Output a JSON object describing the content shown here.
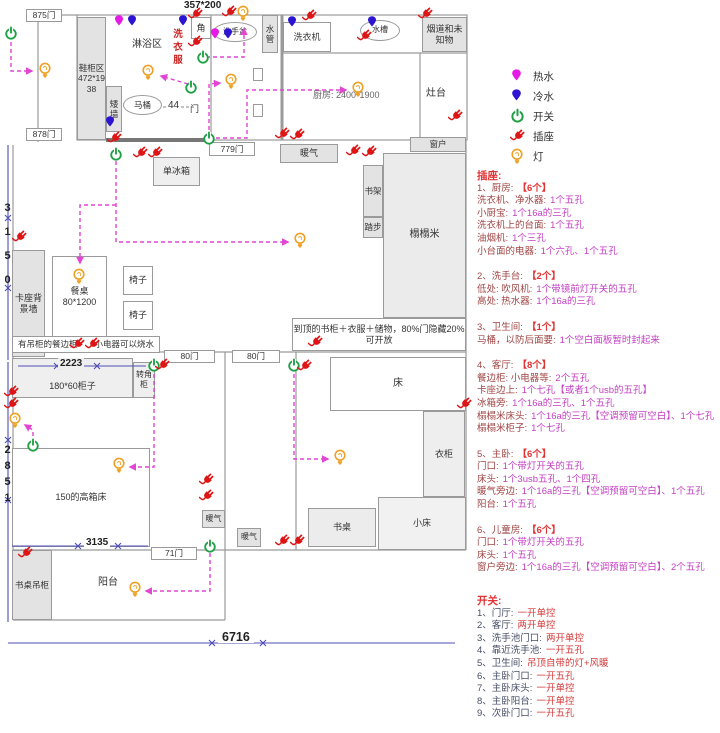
{
  "colors": {
    "hot_water": "#e61ae6",
    "cold_water": "#2d14d2",
    "switch": "#1fa045",
    "outlet": "#dd1515",
    "light": "#f0a125",
    "route_dashed": "#e245d2",
    "dimension": "#4f4fb5",
    "wall": "#9a9a9a",
    "panel_header": "#e23333",
    "panel_label": "#a04545",
    "panel_value": "#c43fc4"
  },
  "icons": {
    "hot-water-pin": "teardrop-pin",
    "cold-water-pin": "teardrop-pin",
    "switch-icon": "power-circle",
    "outlet-icon": "plug",
    "light-icon": "bulb"
  },
  "legend": {
    "items": [
      {
        "icon": "hot-water-pin",
        "label": "热水"
      },
      {
        "icon": "cold-water-pin",
        "label": "冷水"
      },
      {
        "icon": "switch-icon",
        "label": "开关"
      },
      {
        "icon": "outlet-icon",
        "label": "插座"
      },
      {
        "icon": "light-icon",
        "label": "灯"
      }
    ]
  },
  "plan": {
    "dim_top": "357*200",
    "door_875": "875门",
    "door_878": "878门",
    "door_779": "779门",
    "door_80": "80门",
    "door_71": "71门",
    "door_char": "门",
    "shoe": "鞋柜区\n472*19\n38",
    "shower": "淋浴区",
    "laundry": "洗\n衣\n服",
    "corner": "角",
    "basin": "洗手盆",
    "pipe": "水\n管",
    "washer": "洗衣机",
    "sink": "水槽",
    "flue": "烟道和未\n知物",
    "stove": "灶台",
    "kitchen": "厨房: 2400*1900",
    "lowwall": "矮\n墙",
    "toilet": "马桶",
    "d44": "44",
    "fridge": "单冰箱",
    "radiator": "暖气",
    "window": "窗户",
    "bookshelf": "书架",
    "steps": "踏步",
    "tatami": "榻榻米",
    "bookcase": "到顶的书柜＋衣服＋储物，80%门隐藏20%\n可开放",
    "card_wall": "卡座背\n景墙",
    "table": "餐桌\n80*1200",
    "chair": "椅子",
    "sideboard_left": "有吊柜的餐边柜",
    "sideboard_right": "小电器可以烧水",
    "dim_3150": "3\n1\n5\n0",
    "dim_2851": "2\n8\n5\n1",
    "dim_2223": "2223",
    "cab18060": "180*60柜子",
    "corner_cab": "转角柜",
    "bed_high": "150的高箱床",
    "dim_3135": "3135",
    "dim_6716": "6716",
    "bed": "床",
    "wardrobe": "衣柜",
    "small_bed": "小床",
    "desk": "书桌",
    "desk_cab": "书桌吊柜",
    "balcony": "阳台"
  },
  "panel": {
    "sections": [
      {
        "title": "插座:",
        "lines": [
          {
            "p": [
              [
                "1、厨房:",
                "lb"
              ],
              [
                "【6个】",
                "ct"
              ]
            ]
          },
          {
            "p": [
              [
                "洗衣机、净水器:",
                "lb"
              ],
              [
                "1个五孔",
                "vl"
              ]
            ]
          },
          {
            "p": [
              [
                "小厨宝:",
                "lb"
              ],
              [
                "1个16a的三孔",
                "vl"
              ]
            ]
          },
          {
            "p": [
              [
                "洗衣机上的台面:",
                "lb"
              ],
              [
                "1个五孔",
                "vl"
              ]
            ]
          },
          {
            "p": [
              [
                "油烟机:",
                "lb"
              ],
              [
                "1个三孔",
                "vl"
              ]
            ]
          },
          {
            "p": [
              [
                "小台面的电器:",
                "lb"
              ],
              [
                "1个六孔、1个五孔",
                "vl"
              ]
            ]
          },
          {
            "g": 1,
            "p": [
              [
                "2、洗手台:",
                "lb"
              ],
              [
                "【2个】",
                "ct"
              ]
            ]
          },
          {
            "p": [
              [
                "低处: 吹风机:",
                "lb"
              ],
              [
                "1个带镜前灯开关的五孔",
                "vl"
              ]
            ]
          },
          {
            "p": [
              [
                "高处: 热水器:",
                "lb"
              ],
              [
                "1个16a的三孔",
                "vl"
              ]
            ]
          },
          {
            "g": 1,
            "p": [
              [
                "3、卫生间:",
                "lb"
              ],
              [
                "【1个】",
                "ct"
              ]
            ]
          },
          {
            "p": [
              [
                "马桶，以防后面要:",
                "lb"
              ],
              [
                "1个空白面板暂时封起来",
                "vl"
              ]
            ]
          },
          {
            "g": 1,
            "p": [
              [
                "4、客厅:",
                "lb"
              ],
              [
                "【8个】",
                "ct"
              ]
            ]
          },
          {
            "p": [
              [
                "餐边柜: 小电器等:",
                "lb"
              ],
              [
                "2个五孔",
                "vl"
              ]
            ]
          },
          {
            "p": [
              [
                "卡座边上:",
                "lb"
              ],
              [
                "1个七孔【或者1个usb的五孔】",
                "vl"
              ]
            ]
          },
          {
            "p": [
              [
                "冰箱旁:",
                "lb"
              ],
              [
                "1个16a的三孔、1个五孔",
                "vl"
              ]
            ]
          },
          {
            "p": [
              [
                "榻榻米床头:",
                "lb"
              ],
              [
                "1个16a的三孔【空调预留可空白】、1个七孔",
                "vl"
              ]
            ]
          },
          {
            "p": [
              [
                "榻榻米柜子:",
                "lb"
              ],
              [
                "1个七孔",
                "vl"
              ]
            ]
          },
          {
            "g": 1,
            "p": [
              [
                "5、主卧:",
                "lb"
              ],
              [
                "【6个】",
                "ct"
              ]
            ]
          },
          {
            "p": [
              [
                "门口:",
                "lb"
              ],
              [
                "1个带灯开关的五孔",
                "vl"
              ]
            ]
          },
          {
            "p": [
              [
                "床头:",
                "lb"
              ],
              [
                "1个3usb五孔、1个四孔",
                "vl"
              ]
            ]
          },
          {
            "p": [
              [
                "暖气旁边:",
                "lb"
              ],
              [
                "1个16a的三孔【空调预留可空白】、1个五孔",
                "vl"
              ]
            ]
          },
          {
            "p": [
              [
                "阳台:",
                "lb"
              ],
              [
                "1个五孔",
                "vl"
              ]
            ]
          },
          {
            "g": 1,
            "p": [
              [
                "6、儿童房:",
                "lb"
              ],
              [
                "【6个】",
                "ct"
              ]
            ]
          },
          {
            "p": [
              [
                "门口:",
                "lb"
              ],
              [
                "1个带灯开关的五孔",
                "vl"
              ]
            ]
          },
          {
            "p": [
              [
                "床头:",
                "lb"
              ],
              [
                "1个五孔",
                "vl"
              ]
            ]
          },
          {
            "p": [
              [
                "窗户旁边:",
                "lb"
              ],
              [
                "1个16a的三孔【空调预留可空白】、2个五孔",
                "vl"
              ]
            ]
          }
        ]
      },
      {
        "title": "开关:",
        "lines": [
          {
            "p": [
              [
                "1、门厅:",
                "sl"
              ],
              [
                "一开单控",
                "sv"
              ]
            ]
          },
          {
            "p": [
              [
                "2、客厅:",
                "sl"
              ],
              [
                "两开单控",
                "sv"
              ]
            ]
          },
          {
            "p": [
              [
                "3、洗手池门口:",
                "sl"
              ],
              [
                "两开单控",
                "sv"
              ]
            ]
          },
          {
            "p": [
              [
                "4、靠近洗手池:",
                "sl"
              ],
              [
                "一开五孔",
                "sv"
              ]
            ]
          },
          {
            "p": [
              [
                "5、卫生间:",
                "sl"
              ],
              [
                "吊顶自带的灯+风暖",
                "sv"
              ]
            ]
          },
          {
            "p": [
              [
                "6、主卧门口:",
                "sl"
              ],
              [
                "一开五孔",
                "sv"
              ]
            ]
          },
          {
            "p": [
              [
                "7、主卧床头:",
                "sl"
              ],
              [
                "一开单控",
                "sv"
              ]
            ]
          },
          {
            "p": [
              [
                "8、主卧阳台:",
                "sl"
              ],
              [
                "一开单控",
                "sv"
              ]
            ]
          },
          {
            "p": [
              [
                "9、次卧门口:",
                "sl"
              ],
              [
                "一开五孔",
                "sv"
              ]
            ]
          }
        ]
      }
    ]
  }
}
